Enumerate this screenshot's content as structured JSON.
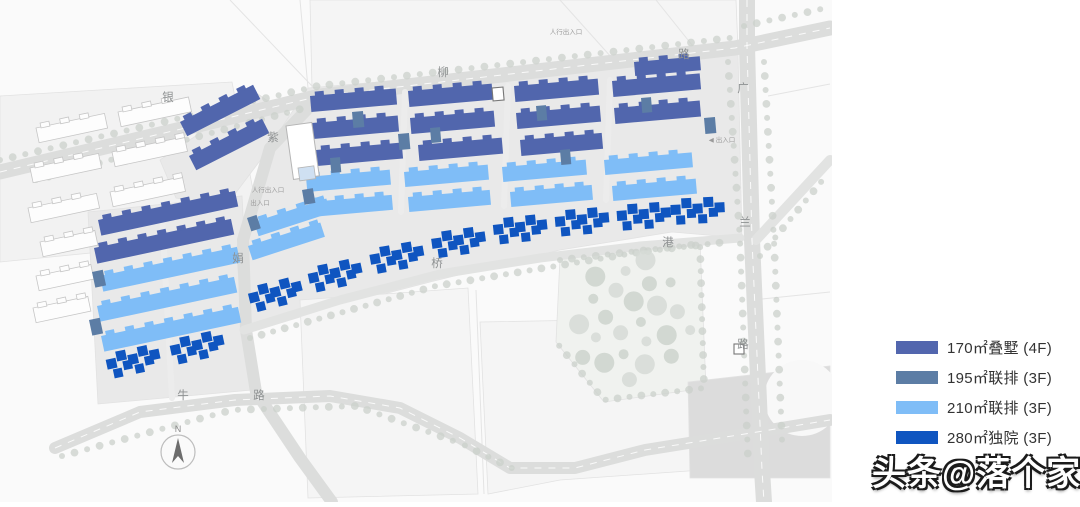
{
  "page": {
    "background": "#ffffff"
  },
  "watermark": {
    "text": "头条@落个家"
  },
  "legend": {
    "items": [
      {
        "label": "170㎡叠墅 (4F)",
        "color": "#5266ae",
        "type": "p"
      },
      {
        "label": "195㎡联排 (3F)",
        "color": "#5c7da5",
        "type": "s"
      },
      {
        "label": "210㎡联排 (3F)",
        "color": "#7fbdf7",
        "type": "l"
      },
      {
        "label": "280㎡独院 (3F)",
        "color": "#0f55c0",
        "type": "d"
      }
    ]
  },
  "map": {
    "width": 832,
    "height": 502,
    "background": "#fafafa",
    "colors": {
      "p": "#5166ad",
      "s": "#5c7da5",
      "l": "#7fbdf7",
      "d": "#0f55c0",
      "road": "#dcdddc",
      "road_minor": "#e2e3e2",
      "lane": "#ececec",
      "parcel": "#e9e9e9",
      "parcel_future": "#f5f5f5",
      "neighbor": "#f2f2f2",
      "park": "#f0f2ef",
      "tree": "#cbd0cb",
      "park_tree_a": "#d6dad6",
      "park_tree_b": "#cdd3cd",
      "white_bld": "#fdfdfd",
      "white_bld_stroke": "#c6c6c6",
      "civic": "#ffffff",
      "civic_stroke": "#b5b5b5",
      "civic_annex": "#cfe0f2",
      "label": "#8e9192",
      "annotation": "#9b9b9b",
      "faint_line": "#e4e4e4",
      "junction": "#dcdcdc",
      "north": "#6d6d6d"
    },
    "parcels": [
      {
        "name": "neighbor-area",
        "points": [
          [
            0,
            96
          ],
          [
            232,
            82
          ],
          [
            262,
            236
          ],
          [
            0,
            262
          ]
        ],
        "fill": "neighbor"
      },
      {
        "name": "top-strip",
        "points": [
          [
            310,
            0
          ],
          [
            736,
            0
          ],
          [
            738,
            50
          ],
          [
            312,
            88
          ]
        ],
        "fill": "parcel_future"
      },
      {
        "name": "west-triangle",
        "points": [
          [
            160,
            160
          ],
          [
            258,
            94
          ],
          [
            292,
            118
          ],
          [
            226,
            206
          ],
          [
            176,
            198
          ]
        ],
        "fill": "parcel"
      },
      {
        "name": "west-parcel",
        "points": [
          [
            88,
            212
          ],
          [
            242,
            196
          ],
          [
            252,
            390
          ],
          [
            98,
            404
          ]
        ],
        "fill": "parcel"
      },
      {
        "name": "central-parcel",
        "points": [
          [
            308,
            88
          ],
          [
            738,
            52
          ],
          [
            742,
            238
          ],
          [
            672,
            232
          ],
          [
            560,
            250
          ],
          [
            430,
            282
          ],
          [
            330,
            308
          ],
          [
            244,
            334
          ],
          [
            236,
            250
          ],
          [
            268,
            148
          ]
        ],
        "fill": "parcel"
      },
      {
        "name": "future-parcel-1",
        "points": [
          [
            300,
            300
          ],
          [
            468,
            288
          ],
          [
            478,
            494
          ],
          [
            308,
            498
          ]
        ],
        "fill": "parcel_future"
      },
      {
        "name": "future-parcel-2",
        "points": [
          [
            480,
            322
          ],
          [
            700,
            318
          ],
          [
            702,
            470
          ],
          [
            560,
            480
          ],
          [
            488,
            494
          ]
        ],
        "fill": "parcel_future"
      },
      {
        "name": "park",
        "points": [
          [
            560,
            258
          ],
          [
            700,
            242
          ],
          [
            706,
            388
          ],
          [
            604,
            402
          ],
          [
            556,
            342
          ]
        ],
        "fill": "park"
      },
      {
        "name": "se-junction",
        "points": [
          [
            688,
            382
          ],
          [
            830,
            366
          ],
          [
            830,
            478
          ],
          [
            690,
            478
          ]
        ],
        "fill": "junction"
      }
    ],
    "faint_lines": [
      [
        230,
        0,
        312,
        86
      ],
      [
        560,
        0,
        612,
        58
      ],
      [
        656,
        0,
        696,
        50
      ],
      [
        768,
        96,
        830,
        84
      ],
      [
        300,
        0,
        308,
        88
      ],
      [
        752,
        300,
        830,
        292
      ],
      [
        476,
        290,
        484,
        494
      ]
    ],
    "roads": [
      {
        "name": "yinliu-road",
        "pts": [
          [
            0,
            172
          ],
          [
            320,
            96
          ],
          [
            735,
            48
          ],
          [
            830,
            28
          ]
        ],
        "w": 15,
        "dash": true
      },
      {
        "name": "guanglan-road",
        "pts": [
          [
            747,
            0
          ],
          [
            747,
            46
          ],
          [
            752,
            240
          ],
          [
            762,
            470
          ],
          [
            764,
            502
          ]
        ],
        "w": 16,
        "dash": true
      },
      {
        "name": "zijuan-road",
        "pts": [
          [
            320,
            96
          ],
          [
            270,
            148
          ],
          [
            243,
            240
          ],
          [
            246,
            330
          ],
          [
            256,
            392
          ],
          [
            300,
            458
          ],
          [
            332,
            502
          ]
        ],
        "w": 12,
        "dash": false
      },
      {
        "name": "niu-road",
        "pts": [
          [
            55,
            448
          ],
          [
            140,
            412
          ],
          [
            235,
            400
          ],
          [
            330,
            396
          ],
          [
            400,
            408
          ],
          [
            460,
            438
          ],
          [
            510,
            468
          ],
          [
            575,
            468
          ],
          [
            645,
            450
          ],
          [
            757,
            432
          ],
          [
            830,
            420
          ]
        ],
        "w": 12,
        "dash": true
      },
      {
        "name": "gangqiao-road",
        "pts": [
          [
            244,
            330
          ],
          [
            340,
            300
          ],
          [
            440,
            274
          ],
          [
            540,
            258
          ],
          [
            640,
            246
          ],
          [
            740,
            238
          ]
        ],
        "w": 9,
        "dash": false,
        "minor": true
      },
      {
        "name": "ne-diagonal-road",
        "pts": [
          [
            756,
            240
          ],
          [
            830,
            160
          ]
        ],
        "w": 10,
        "dash": false,
        "minor": true
      }
    ],
    "lanes": [
      [
        [
          405,
          92
        ],
        [
          401,
          212
        ]
      ],
      [
        [
          508,
          86
        ],
        [
          504,
          206
        ]
      ],
      [
        [
          610,
          80
        ],
        [
          606,
          200
        ]
      ],
      [
        [
          162,
          214
        ],
        [
          172,
          398
        ]
      ]
    ],
    "tree_lines": [
      {
        "pts": [
          [
            0,
            160
          ],
          [
            318,
            86
          ],
          [
            730,
            38
          ]
        ],
        "sp": 13
      },
      {
        "pts": [
          [
            36,
            180
          ],
          [
            312,
            106
          ]
        ],
        "sp": 13
      },
      {
        "pts": [
          [
            728,
            62
          ],
          [
            740,
            240
          ],
          [
            748,
            460
          ]
        ],
        "sp": 14
      },
      {
        "pts": [
          [
            764,
            62
          ],
          [
            774,
            240
          ],
          [
            782,
            440
          ]
        ],
        "sp": 14
      },
      {
        "pts": [
          [
            62,
            456
          ],
          [
            232,
            410
          ],
          [
            356,
            406
          ],
          [
            462,
            444
          ],
          [
            520,
            472
          ]
        ],
        "sp": 13
      },
      {
        "pts": [
          [
            250,
            338
          ],
          [
            436,
            286
          ],
          [
            640,
            252
          ],
          [
            726,
            242
          ]
        ],
        "sp": 12
      },
      {
        "pts": [
          [
            760,
            256
          ],
          [
            826,
            176
          ]
        ],
        "sp": 12
      },
      {
        "pts": [
          [
            744,
            26
          ],
          [
            826,
            8
          ]
        ],
        "sp": 13
      },
      {
        "pts": [
          [
            560,
            260
          ],
          [
            700,
            244
          ],
          [
            704,
            388
          ],
          [
            604,
            400
          ],
          [
            556,
            342
          ]
        ],
        "sp": 12
      }
    ],
    "park_blob": {
      "cx": 632,
      "cy": 322,
      "rx": 62,
      "ry": 64,
      "n": 24
    },
    "white_corner": {
      "cx": 802,
      "cy": 398,
      "r": 38
    },
    "buildings": [
      [
        "p",
        180,
        122,
        82,
        16,
        -27
      ],
      [
        "p",
        189,
        156,
        82,
        16,
        -27
      ],
      [
        "p",
        98,
        220,
        140,
        16,
        -12
      ],
      [
        "p",
        94,
        248,
        140,
        16,
        -12
      ],
      [
        "p",
        310,
        96,
        86,
        16,
        -5
      ],
      [
        "p",
        408,
        91,
        84,
        16,
        -5
      ],
      [
        "p",
        514,
        86,
        84,
        16,
        -5
      ],
      [
        "p",
        612,
        81,
        88,
        16,
        -5
      ],
      [
        "p",
        634,
        62,
        66,
        14,
        -5
      ],
      [
        "p",
        312,
        123,
        86,
        16,
        -5
      ],
      [
        "p",
        410,
        118,
        84,
        16,
        -5
      ],
      [
        "p",
        516,
        113,
        84,
        16,
        -5
      ],
      [
        "p",
        614,
        108,
        86,
        16,
        -5
      ],
      [
        "p",
        316,
        150,
        86,
        16,
        -5
      ],
      [
        "p",
        418,
        145,
        84,
        16,
        -5
      ],
      [
        "p",
        520,
        140,
        82,
        16,
        -5
      ],
      [
        "l",
        306,
        177,
        84,
        15,
        -5
      ],
      [
        "l",
        404,
        172,
        84,
        15,
        -5
      ],
      [
        "l",
        502,
        167,
        84,
        15,
        -5
      ],
      [
        "l",
        604,
        160,
        88,
        15,
        -5
      ],
      [
        "l",
        310,
        202,
        82,
        15,
        -5
      ],
      [
        "l",
        408,
        197,
        82,
        15,
        -5
      ],
      [
        "l",
        510,
        192,
        82,
        15,
        -5
      ],
      [
        "l",
        612,
        186,
        84,
        15,
        -5
      ],
      [
        "l",
        254,
        222,
        76,
        15,
        -18
      ],
      [
        "l",
        248,
        246,
        76,
        15,
        -18
      ],
      [
        "l",
        100,
        276,
        140,
        16,
        -12
      ],
      [
        "l",
        97,
        306,
        140,
        16,
        -12
      ],
      [
        "l",
        101,
        336,
        140,
        16,
        -12
      ],
      [
        "s",
        352,
        112,
        11,
        16,
        -5
      ],
      [
        "s",
        398,
        134,
        11,
        16,
        -5
      ],
      [
        "s",
        330,
        158,
        10,
        15,
        -5
      ],
      [
        "s",
        430,
        128,
        10,
        15,
        -5
      ],
      [
        "s",
        536,
        106,
        10,
        15,
        -5
      ],
      [
        "s",
        560,
        150,
        10,
        15,
        -5
      ],
      [
        "s",
        302,
        190,
        11,
        15,
        -10
      ],
      [
        "s",
        92,
        272,
        11,
        16,
        -12
      ],
      [
        "s",
        89,
        320,
        11,
        16,
        -12
      ],
      [
        "s",
        641,
        98,
        10,
        15,
        -5
      ],
      [
        "s",
        704,
        118,
        11,
        16,
        -5
      ],
      [
        "s",
        247,
        218,
        10,
        14,
        -18
      ]
    ],
    "dark_clusters": [
      [
        246,
        286,
        -14
      ],
      [
        306,
        266,
        -12
      ],
      [
        368,
        247,
        -10
      ],
      [
        430,
        231,
        -8
      ],
      [
        492,
        217,
        -6
      ],
      [
        554,
        209,
        -5
      ],
      [
        616,
        203,
        -4
      ],
      [
        670,
        197,
        -3
      ],
      [
        104,
        352,
        -12
      ],
      [
        168,
        338,
        -12
      ]
    ],
    "white_rows": [
      [
        36,
        128,
        70
      ],
      [
        118,
        112,
        72
      ],
      [
        30,
        168,
        70
      ],
      [
        112,
        152,
        74
      ],
      [
        28,
        208,
        70
      ],
      [
        110,
        192,
        74
      ],
      [
        40,
        242,
        56
      ],
      [
        36,
        276,
        56
      ],
      [
        33,
        308,
        56
      ]
    ],
    "civic": {
      "main": [
        286,
        126,
        26,
        54,
        -8
      ],
      "annex": [
        298,
        168,
        16,
        13,
        -8
      ]
    },
    "gates": [
      [
        492,
        88,
        11,
        13,
        -5
      ],
      [
        734,
        344,
        10,
        10,
        0
      ]
    ],
    "road_labels": [
      {
        "text": "银",
        "x": 168,
        "y": 101
      },
      {
        "text": "柳",
        "x": 443,
        "y": 76
      },
      {
        "text": "路",
        "x": 684,
        "y": 58
      },
      {
        "text": "广",
        "x": 743,
        "y": 92
      },
      {
        "text": "兰",
        "x": 745,
        "y": 226
      },
      {
        "text": "路",
        "x": 743,
        "y": 348
      },
      {
        "text": "紫",
        "x": 273,
        "y": 141
      },
      {
        "text": "娟",
        "x": 238,
        "y": 262
      },
      {
        "text": "桥",
        "x": 437,
        "y": 267
      },
      {
        "text": "港",
        "x": 668,
        "y": 246
      },
      {
        "text": "牛",
        "x": 183,
        "y": 399
      },
      {
        "text": "路",
        "x": 259,
        "y": 399
      }
    ],
    "annotations": [
      {
        "text": "人行出入口",
        "x": 268,
        "y": 192
      },
      {
        "text": "出入口",
        "x": 260,
        "y": 205
      },
      {
        "text": "◀ 出入口",
        "x": 722,
        "y": 142
      },
      {
        "text": "人行出入口",
        "x": 566,
        "y": 34
      }
    ],
    "north_arrow": {
      "x": 178,
      "y": 452,
      "r": 17,
      "label": "N"
    }
  }
}
